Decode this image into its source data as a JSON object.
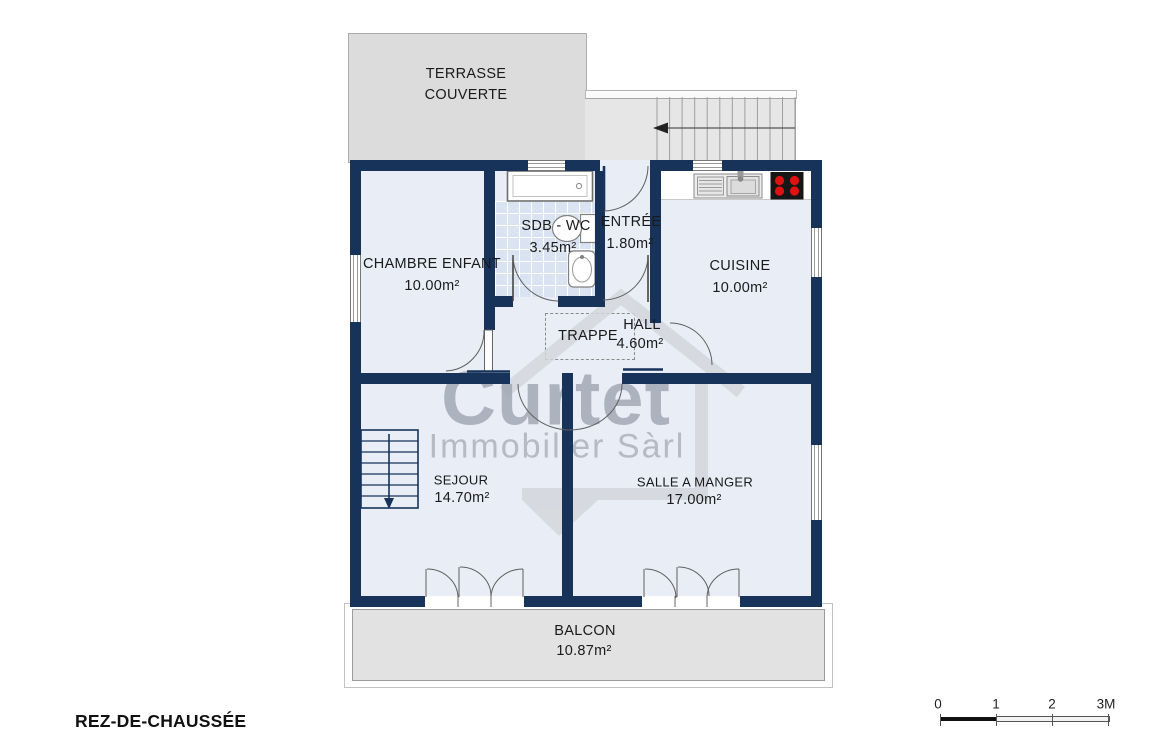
{
  "plan_title": "REZ-DE-CHAUSSÉE",
  "watermark": {
    "brand": "Curtet",
    "subtitle": "Immobilier Sàrl"
  },
  "outdoor": {
    "terrace_label": "TERRASSE\nCOUVERTE",
    "balcony_label": "BALCON",
    "balcony_area": "10.87m²"
  },
  "rooms": {
    "chambre": {
      "label": "CHAMBRE ENFANT",
      "area": "10.00m²"
    },
    "sdb": {
      "label": "SDB - WC",
      "area": "3.45m²"
    },
    "entree": {
      "label": "ENTRÉE",
      "area": "1.80m²"
    },
    "cuisine": {
      "label": "CUISINE",
      "area": "10.00m²"
    },
    "hall": {
      "label": "HALL",
      "area": "4.60m²"
    },
    "trappe": {
      "label": "TRAPPE"
    },
    "sejour": {
      "label": "SEJOUR",
      "area": "14.70m²"
    },
    "salle_a_manger": {
      "label": "SALLE A MANGER",
      "area": "17.00m²"
    }
  },
  "scale_bar": {
    "ticks": [
      "0",
      "1",
      "2",
      "3M"
    ]
  },
  "colors": {
    "wall": "#17335a",
    "floor": "#e8edf6",
    "terrace": "#dcdcdc",
    "balcony": "#e2e2e2",
    "stove_burner": "#e01111"
  }
}
